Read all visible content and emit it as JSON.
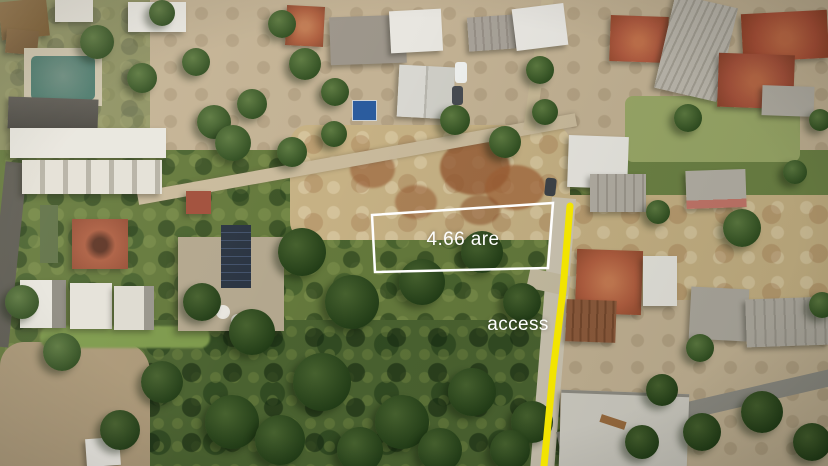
{
  "annotations": {
    "plot": {
      "area_label": "4.66 are",
      "outline_color": "#ffffff"
    },
    "access": {
      "label": "access",
      "line_color": "#f2e400",
      "text_color": "#ffffff"
    }
  }
}
